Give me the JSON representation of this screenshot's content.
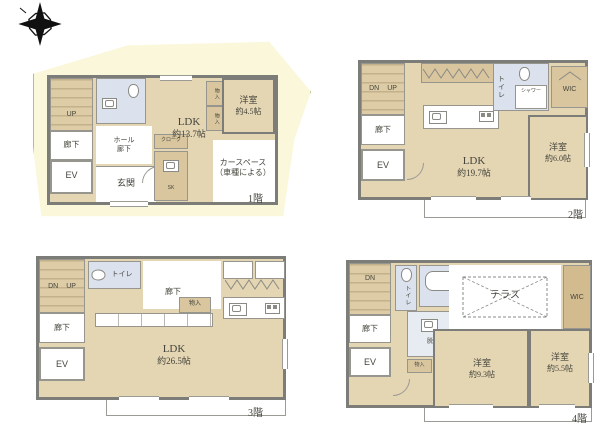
{
  "compass": {
    "icon": "north-compass-star"
  },
  "colors": {
    "land": "#fbf7da",
    "room_floor": "#e4d5b3",
    "closet_tan": "#d9c69e",
    "wet_area_blue": "#dce2ed",
    "wall_gray": "#7c7c78"
  },
  "floor1": {
    "floor_label": "1階",
    "stairs_up": "UP",
    "corridor": "廊下",
    "elevator": "EV",
    "hall_line1": "ホール",
    "hall_line2": "廊下",
    "entrance": "玄関",
    "cloak": "クローク",
    "sk": "SK",
    "ldk": "LDK",
    "ldk_size": "約13.7帖",
    "storage_a": "物入",
    "storage_b": "物入",
    "western_room": "洋室",
    "western_room_size": "約4.5帖",
    "car_space_line1": "カースペース",
    "car_space_line2": "（車種による）"
  },
  "floor2": {
    "floor_label": "2階",
    "stairs_dn": "DN",
    "stairs_up": "UP",
    "corridor": "廊下",
    "elevator": "EV",
    "ldk": "LDK",
    "ldk_size": "約19.7帖",
    "toilet": "トイレ",
    "shower": "シャワー",
    "wic": "WIC",
    "western_room": "洋室",
    "western_room_size": "約6.0帖"
  },
  "floor3": {
    "floor_label": "3階",
    "stairs_dn": "DN",
    "stairs_up": "UP",
    "corridor": "廊下",
    "corridor_upper": "廊下",
    "elevator": "EV",
    "toilet": "トイレ",
    "storage": "物入",
    "ldk": "LDK",
    "ldk_size": "約26.5帖"
  },
  "floor4": {
    "floor_label": "4階",
    "stairs_dn": "DN",
    "corridor": "廊下",
    "elevator": "EV",
    "toilet": "トイレ",
    "dressing_room": "脱衣所",
    "storage_a": "物入",
    "storage_b": "物入",
    "terrace": "テラス",
    "wic": "WIC",
    "western_room_a": "洋室",
    "western_room_a_size": "約9.3帖",
    "western_room_b": "洋室",
    "western_room_b_size": "約5.5帖"
  }
}
